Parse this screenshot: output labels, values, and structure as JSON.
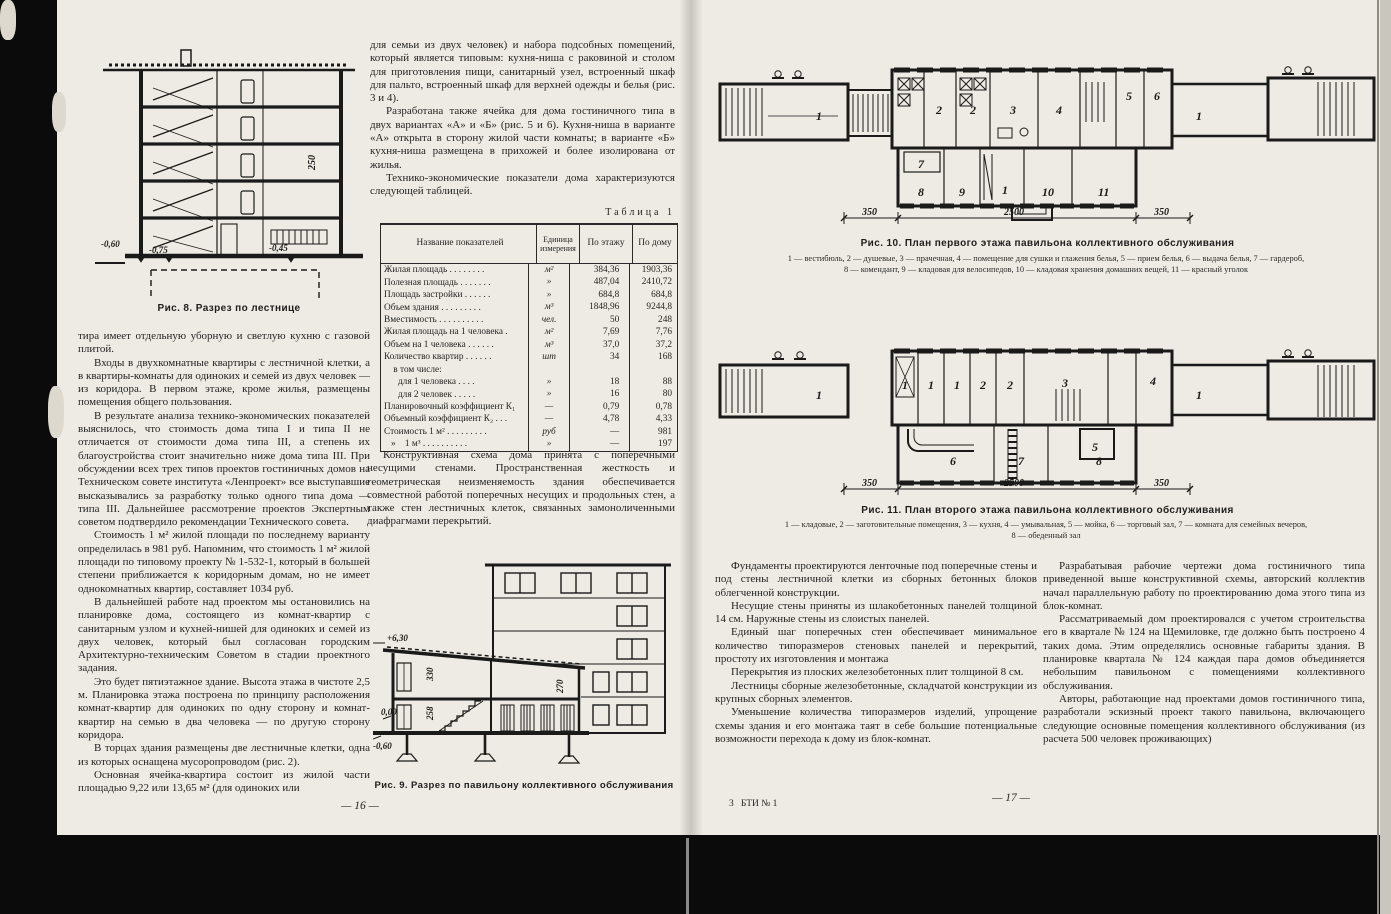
{
  "scan": {
    "page_left_number": "— 16 —",
    "page_right_number": "— 17 —",
    "print_signature": "3   БТИ № 1"
  },
  "page_left": {
    "figure8": {
      "caption": "Рис. 8. Разрез по лестнице",
      "levels": [
        "-0,60",
        "-0,75",
        "-0,45"
      ],
      "dim": "250"
    },
    "column1": [
      "тира имеет отдельную уборную и светлую кухню с газовой плитой.",
      "Входы в двухкомнатные квартиры с лестничной клетки, а в квартиры-комнаты для одиноких и семей из двух человек — из коридора. В первом этаже, кроме жилья, размещены помещения общего пользования.",
      "В результате анализа технико-экономических показателей выяснилось, что стоимость дома типа I и типа II не отличается от стоимости дома типа III, а степень их благоустройства стоит значительно ниже дома типа III. При обсуждении всех трех типов проектов гостиничных домов на Техническом совете института «Ленпроект» все выступавшие высказывались за разработку только одного типа дома — типа III. Дальнейшее рассмотрение проектов Экспертным советом подтвердило рекомендации Технического совета.",
      "Стоимость 1 м² жилой площади по последнему варианту определилась в 981 руб. Напомним, что стоимость 1 м² жилой площади по типовому проекту № 1-532-1, который в большей степени приближается к коридорным домам, но не имеет однокомнатных квартир, составляет 1034 руб.",
      "В дальнейшей работе над проектом мы остановились на планировке дома, состоящего из комнат-квартир с санитарным узлом и кухней-нишей для одиноких и семей из двух человек, который был согласован городским Архитектурно-техническим Советом в стадии проектного задания.",
      "Это будет пятиэтажное здание. Высота этажа в чистоте 2,5 м. Планировка этажа построена по принципу расположения комнат-квартир для одиноких по одну сторону и комнат-квартир на семью в два человека — по другую сторону коридора.",
      "В торцах здания размещены две лестничные клетки, одна из которых оснащена мусоропроводом (рис. 2).",
      "Основная ячейка-квартира состоит из жилой части площадью 9,22 или 13,65 м² (для одиноких или"
    ],
    "column2_top": [
      "для семьи из двух человек) и набора подсобных помещений, который является типовым: кухня-ниша с раковиной и столом для приготовления пищи, санитарный узел, встроенный шкаф для пальто, встроенный шкаф для верхней одежды и белья (рис. 3 и 4).",
      "Разработана также ячейка для дома гостиничного типа в двух вариантах «А» и «Б» (рис. 5 и 6). Кухня-ниша в варианте «А» открыта в сторону жилой части комнаты; в варианте «Б» кухня-ниша размещена в прихожей и более изолирована от жилья.",
      "Технико-экономические показатели дома характеризуются следующей таблицей."
    ],
    "table_label": "Таблица 1",
    "table": {
      "headers": [
        "Название показателей",
        "Единица измерения",
        "По этажу",
        "По дому"
      ],
      "rows": [
        [
          "Жилая площадь . . . . . . . .",
          "м²",
          "384,36",
          "1903,36"
        ],
        [
          "Полезная площадь . . . . . . .",
          "»",
          "487,04",
          "2410,72"
        ],
        [
          "Площадь застройки . . . . . .",
          "»",
          "684,8",
          "684,8"
        ],
        [
          "Объем здания . . . . . . . . .",
          "м³",
          "1848,96",
          "9244,8"
        ],
        [
          "Вместимость . . . . . . . . . .",
          "чел.",
          "50",
          "248"
        ],
        [
          "Жилая площадь на 1 человека .",
          "м²",
          "7,69",
          "7,76"
        ],
        [
          "Объем на 1 человека . . . . . .",
          "м³",
          "37,0",
          "37,2"
        ],
        [
          "Количество квартир . . . . . .",
          "шт",
          "34",
          "168"
        ],
        [
          "    в том числе:",
          "",
          "",
          ""
        ],
        [
          "      для 1 человека . . . .",
          "»",
          "18",
          "88"
        ],
        [
          "      для 2 человек . . . . .",
          "»",
          "16",
          "80"
        ],
        [
          "Планировочный коэффициент К₁",
          "—",
          "0,79",
          "0,78"
        ],
        [
          "Объемный коэффициент К₂ . . .",
          "—",
          "4,78",
          "4,33"
        ],
        [
          "Стоимость 1 м² . . . . . . . . .",
          "руб",
          "—",
          "981"
        ],
        [
          "   »    1 м³ . . . . . . . . . .",
          "»",
          "—",
          "197"
        ]
      ]
    },
    "column2_after_table": [
      "Конструктивная схема дома принята с поперечными несущими стенами. Пространственная жесткость и геометрическая неизменяемость здания обеспечивается совместной работой поперечных несущих и продольных стен, а также стен лестничных клеток, связанных замоноличенными диафрагмами перекрытий."
    ],
    "figure9": {
      "caption": "Рис. 9. Разрез  по павильону коллективного обслуживания",
      "levels": [
        "+6,30",
        "0,00",
        "-0,60"
      ],
      "dims": [
        "330",
        "270",
        "258"
      ]
    }
  },
  "page_right": {
    "figure10": {
      "caption": "Рис. 10. План первого этажа павильона коллективного обслуживания",
      "legend_line1": "1 — вестибюль,  2 — душевые,  3 — прачечная,  4 — помещение для сушки и глажения белья,  5 — прием белья,  6 — выдача белья,  7 — гардероб,",
      "legend_line2": "8 — комендант,  9 — кладовая для велосипедов,  10 — кладовая хранения домашних вещей,  11 — красный уголок",
      "dims": [
        "350",
        "2500",
        "350"
      ],
      "room_labels": [
        "1",
        "2",
        "2",
        "3",
        "4",
        "5",
        "6",
        "7",
        "8",
        "9",
        "1",
        "10",
        "11",
        "1"
      ]
    },
    "figure11": {
      "caption": "Рис. 11. План второго этажа павильона коллективного обслуживания",
      "legend_line1": "1 — кладовые,  2 — заготовительные помещения,  3 — кухня,  4 — умывальная,  5 — мойка,  6 — торговый зал,  7 — комната для семейных вечеров,",
      "legend_line2": "8 — обеденный зал",
      "dims": [
        "350",
        "2500",
        "350"
      ],
      "room_labels": [
        "1",
        "1",
        "1",
        "1",
        "2",
        "2",
        "3",
        "4",
        "5",
        "6",
        "7",
        "8",
        "1"
      ]
    },
    "column1": [
      "Фундаменты проектируются ленточные под поперечные стены и под стены лестничной клетки из сборных бетонных блоков облегченной конструкции.",
      "Несущие стены приняты из шлакобетонных панелей толщиной 14 см. Наружные стены из слоистых панелей.",
      "Единый шаг поперечных стен обеспечивает минимальное количество типоразмеров стеновых панелей и перекрытий, простоту их изготовления и монтажа",
      "Перекрытия из плоских железобетонных плит толщиной 8 см.",
      "Лестницы сборные железобетонные, складчатой конструкции из крупных сборных элементов.",
      "Уменьшение количества типоразмеров изделий, упрощение схемы здания и его монтажа таят в себе большие потенциальные возможности перехода к дому из блок-комнат."
    ],
    "column2": [
      "Разрабатывая рабочие чертежи дома гостиничного типа приведенной выше конструктивной схемы, авторский коллектив начал параллельную работу по проектированию дома этого типа из блок-комнат.",
      "Рассматриваемый дом проектировался с учетом строительства его в квартале № 124 на Щемиловке, где должно быть построено 4 таких дома. Этим определялись основные габариты здания. В планировке квартала № 124 каждая пара домов объединяется небольшим павильоном с помещениями коллективного обслуживания.",
      "Авторы, работающие над проектами домов гостиничного типа, разработали эскизный проект такого павильона, включающего следующие основные помещения коллективного обслуживания (из расчета 500 человек проживающих)"
    ]
  }
}
